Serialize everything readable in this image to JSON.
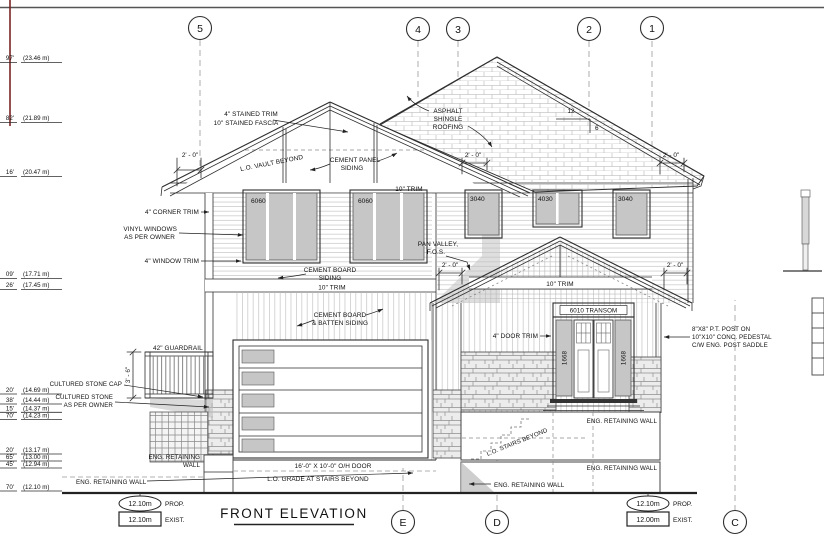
{
  "title": {
    "text": "FRONT ELEVATION"
  },
  "grid": {
    "top": [
      {
        "label": "5"
      },
      {
        "label": "4"
      },
      {
        "label": "3"
      },
      {
        "label": "2"
      },
      {
        "label": "1"
      }
    ],
    "bottom": [
      {
        "label": "E"
      },
      {
        "label": "D"
      },
      {
        "label": "C"
      }
    ]
  },
  "datum": {
    "left": {
      "prop_value": "12.10m",
      "prop_label": "PROP.",
      "exist_value": "12.10m",
      "exist_label": "EXIST."
    },
    "right": {
      "prop_value": "12.10m",
      "prop_label": "PROP.",
      "exist_value": "12.00m",
      "exist_label": "EXIST."
    }
  },
  "elevations": [
    {
      "ft": "97'",
      "m": "(23.46 m)"
    },
    {
      "ft": "82'",
      "m": "(21.89 m)"
    },
    {
      "ft": "16'",
      "m": "(20.47 m)"
    },
    {
      "ft": "09'",
      "m": "(17.71 m)"
    },
    {
      "ft": "26'",
      "m": "(17.45 m)"
    },
    {
      "ft": "20'",
      "m": "(14.69 m)"
    },
    {
      "ft": "38'",
      "m": "(14.44 m)"
    },
    {
      "ft": "15'",
      "m": "(14.37 m)"
    },
    {
      "ft": "70'",
      "m": "(14.23 m)"
    },
    {
      "ft": "20'",
      "m": "(13.17 m)"
    },
    {
      "ft": "65'",
      "m": "(13.00 m)"
    },
    {
      "ft": "45'",
      "m": "(12.94 m)"
    },
    {
      "ft": "70'",
      "m": "(12.10 m)"
    }
  ],
  "labels": {
    "stained_trim_1": "4\" STAINED TRIM",
    "stained_trim_2": "10\" STAINED FASCIA",
    "lo_vault": "L.O. VAULT BEYOND",
    "cement_panel_1": "CEMENT PANEL",
    "cement_panel_2": "SIDING",
    "trim_10": "10\" TRIM",
    "asphalt_1": "ASPHALT",
    "asphalt_2": "SHINGLE",
    "asphalt_3": "ROOFING",
    "corner_trim": "4\" CORNER TRIM",
    "vinyl_1": "VINYL WINDOWS",
    "vinyl_2": "AS PER OWNER",
    "window_trim": "4\" WINDOW TRIM",
    "pan_valley_1": "PAN VALLEY,",
    "pan_valley_2": "F.O.S.",
    "cement_board_1": "CEMENT BOARD",
    "cement_board_2": "SIDING",
    "batten_1": "CEMENT BOARD",
    "batten_2": "& BATTEN SIDING",
    "guardrail": "42\" GUARDRAIL",
    "cultured_cap": "CULTURED STONE CAP",
    "cultured_1": "CULTURED STONE",
    "cultured_2": "AS PER OWNER",
    "eng_wall": "ENG. RETAINING WALL",
    "eng_wall_1": "ENG. RETAINING",
    "eng_wall_2": "WALL",
    "oh_door": "16'-0\" X 10'-0\" O/H DOOR",
    "lo_grade": "L.O. GRADE AT STAIRS BEYOND",
    "lo_stairs": "L.O. STAIRS BEYOND",
    "door_trim": "4\" DOOR TRIM",
    "post_1": "8\"X8\" P.T. POST ON",
    "post_2": "10\"X10\" CONC. PEDESTAL",
    "post_3": "C/W ENG. POST SADDLE"
  },
  "windows": {
    "w6060": "6060",
    "w3040": "3040",
    "w4030": "4030",
    "transom": "6010 TRANSOM",
    "sidelight": "1668"
  },
  "dims": {
    "two_feet": "2' - 0\"",
    "guard_height": "3' - 6\"",
    "slope_rise": "12",
    "slope_run": "6"
  }
}
